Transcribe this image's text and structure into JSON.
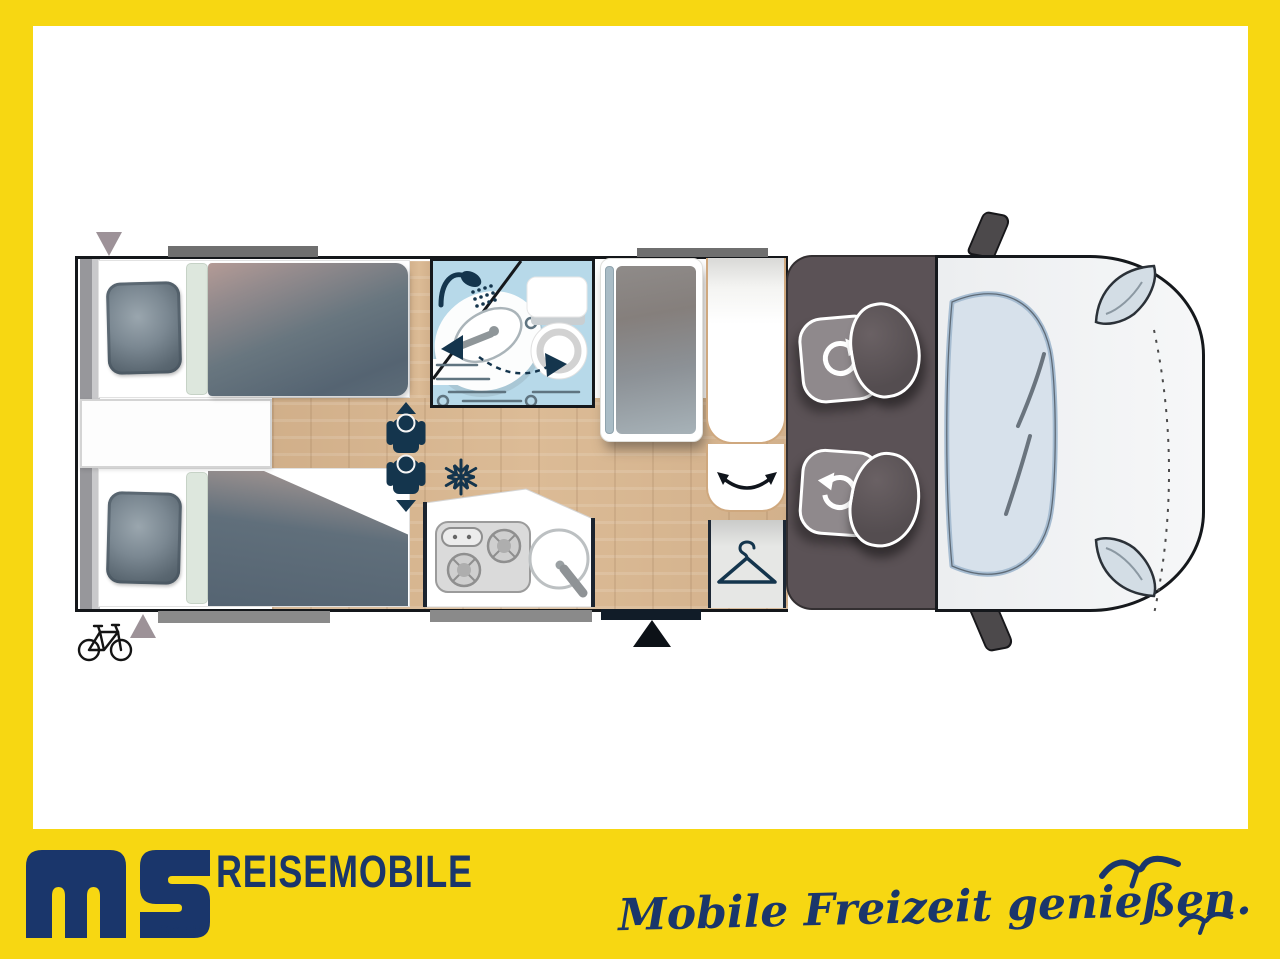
{
  "brand": {
    "logo_monogram": "MS",
    "logo_sub": "GmbH",
    "company_line": "REISEMOBILE",
    "tagline": "Mobile Freizeit genießen."
  },
  "floorplan": {
    "type": "motorhome top-view floor plan",
    "zones": [
      "twin single beds (rear)",
      "bathroom with swivel washbasin",
      "tall fridge cabinet",
      "dinette seat",
      "wardrobe",
      "kitchen with hob and sink",
      "cab with two swivel seats",
      "vehicle front"
    ],
    "icons": {
      "shower-icon": "shower head with spray dots",
      "washbasin-swivel-icon": "oval basin with dashed swing arrow toward toilet",
      "toilet-icon": "cassette toilet with tank and bowl",
      "snowflake-icon": "fridge position marker",
      "hanger-icon": "wardrobe marker",
      "person-icons": "two travel positions with up/down direction arrows",
      "entry-arrow-icon": "black triangle marking entrance door",
      "bicycle-icon": "bike storage at rear",
      "seat-rotation-icons": "white circular arrows on both cab seats",
      "door-swing-arrow-icon": "curved double arrow on dinette seat",
      "window-markers": "gray bars on outer walls",
      "vent-markers": "gray triangles at rear wall"
    }
  },
  "colors": {
    "frame_yellow": "#F7D712",
    "brand_navy": "#1A366B",
    "bathroom_blue": "#B7D9E9",
    "floor_wood": "#D9B893",
    "cab_gray": "#5B5256",
    "mattress_slate": "#5E6D79",
    "window_gray": "#6F6F6F",
    "icon_navy": "#14354D"
  }
}
